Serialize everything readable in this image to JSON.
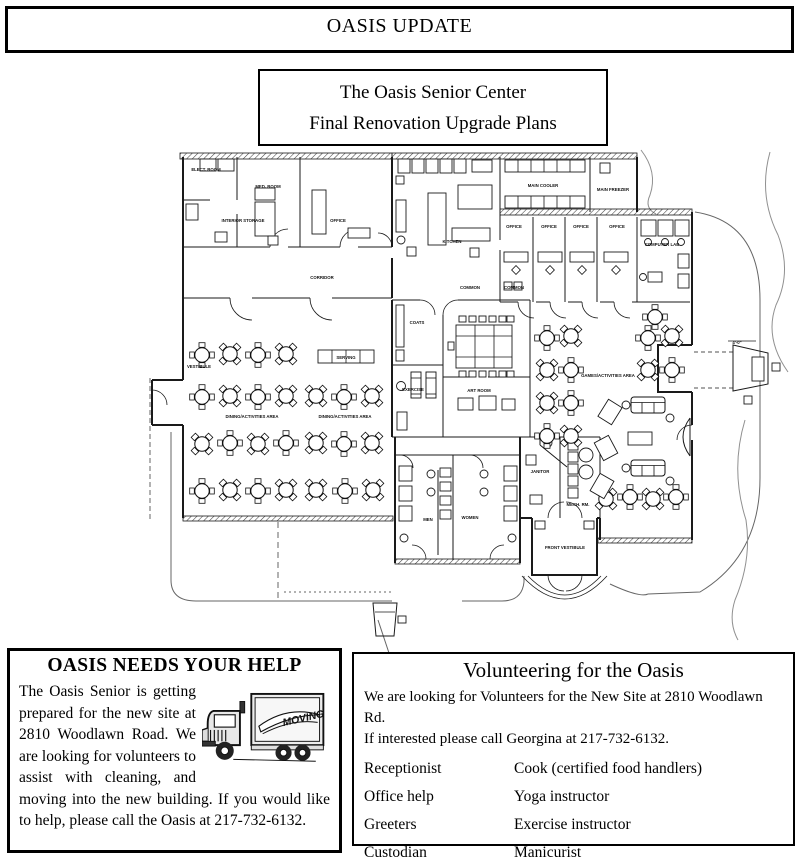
{
  "masthead": {
    "title": "OASIS UPDATE"
  },
  "plan_title": {
    "line1": "The Oasis Senior Center",
    "line2": "Final Renovation Upgrade Plans"
  },
  "help_box": {
    "title": "OASIS NEEDS YOUR HELP",
    "body": "The Oasis Senior is getting prepared for the new site at 2810 Woodlawn Road.  We are looking for volunteers to assist with cleaning, and moving into the new building.  If you would like to help, please call the Oasis at 217-732-6132.",
    "truck_label": "MOVING"
  },
  "volunteer_box": {
    "title": "Volunteering for the Oasis",
    "intro": "We are looking for Volunteers for the New Site at 2810 Woodlawn Rd.\nIf interested please call Georgina at 217-732-6132.",
    "roles_left": [
      "Receptionist",
      "Office help",
      "Greeters",
      "Custodian",
      "Lawn care"
    ],
    "roles_right": [
      "Cook (certified food handlers)",
      "Yoga instructor",
      "Exercise instructor",
      "Manicurist",
      "Window washer"
    ]
  },
  "floor_plan": {
    "labels": [
      {
        "t": "ELECT. ROOM",
        "x": 206,
        "y": 171
      },
      {
        "t": "MED. ROOM",
        "x": 268,
        "y": 188
      },
      {
        "t": "INTERIOR STORAGE",
        "x": 243,
        "y": 222
      },
      {
        "t": "OFFICE",
        "x": 338,
        "y": 222
      },
      {
        "t": "MAIN COOLER",
        "x": 543,
        "y": 187
      },
      {
        "t": "MAIN FREEZER",
        "x": 613,
        "y": 191
      },
      {
        "t": "KITCHEN",
        "x": 452,
        "y": 243
      },
      {
        "t": "CORRIDOR",
        "x": 322,
        "y": 279
      },
      {
        "t": "VESTIBULE",
        "x": 199,
        "y": 368
      },
      {
        "t": "OFFICE",
        "x": 514,
        "y": 228
      },
      {
        "t": "OFFICE",
        "x": 549,
        "y": 228
      },
      {
        "t": "OFFICE",
        "x": 581,
        "y": 228
      },
      {
        "t": "OFFICE",
        "x": 617,
        "y": 228
      },
      {
        "t": "COMPUTER LAB",
        "x": 662,
        "y": 246
      },
      {
        "t": "COMMON",
        "x": 470,
        "y": 289
      },
      {
        "t": "COMMON",
        "x": 514,
        "y": 289
      },
      {
        "t": "COATS",
        "x": 417,
        "y": 324
      },
      {
        "t": "SERVING",
        "x": 346,
        "y": 359
      },
      {
        "t": "DINING/ACTIVITIES AREA",
        "x": 252,
        "y": 418
      },
      {
        "t": "DINING/ACTIVITIES AREA",
        "x": 345,
        "y": 418
      },
      {
        "t": "GAMES/ACTIVITIES AREA",
        "x": 608,
        "y": 377
      },
      {
        "t": "EXERCISE",
        "x": 413,
        "y": 391
      },
      {
        "t": "ART ROOM",
        "x": 479,
        "y": 392
      },
      {
        "t": "MEN",
        "x": 428,
        "y": 521
      },
      {
        "t": "WOMEN",
        "x": 470,
        "y": 519
      },
      {
        "t": "JANITOR",
        "x": 540,
        "y": 473
      },
      {
        "t": "MECH. RM.",
        "x": 578,
        "y": 506
      },
      {
        "t": "FRONT VESTIBULE",
        "x": 565,
        "y": 549
      },
      {
        "t": "4'-0\"",
        "x": 737,
        "y": 344
      }
    ]
  }
}
